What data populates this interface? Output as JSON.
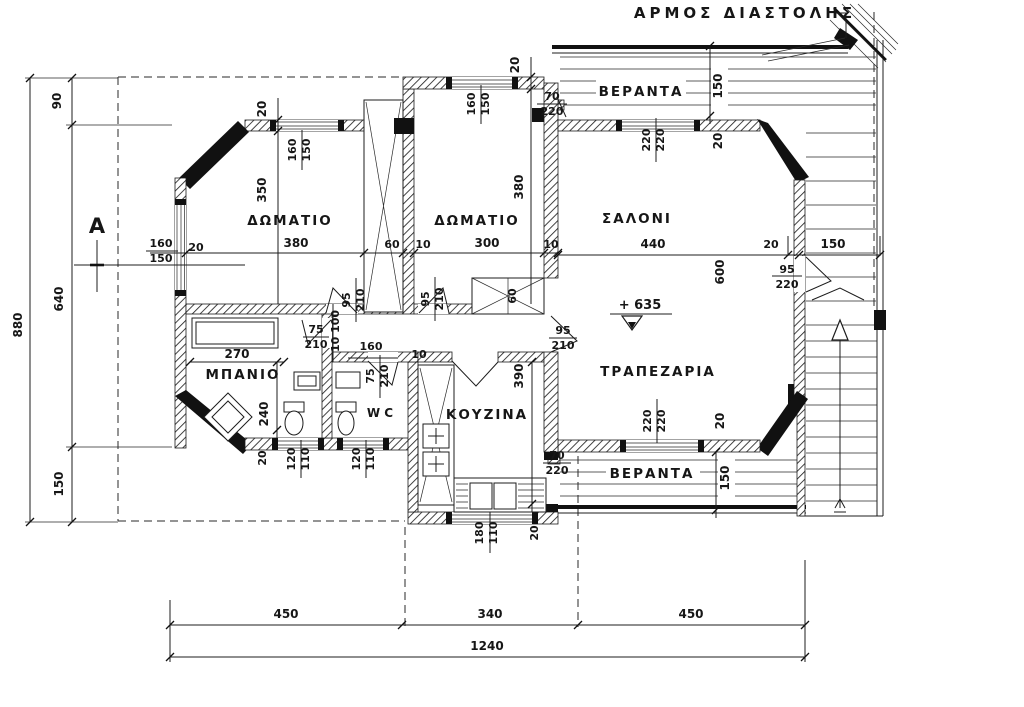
{
  "drawing": {
    "note": "ΑΡΜΟΣ ΔΙΑΣΤΟΛΗΣ",
    "level": "+ 635",
    "section": "A",
    "rooms": {
      "bedroom1": "ΔΩΜΑΤΙΟ",
      "bedroom2": "ΔΩΜΑΤΙΟ",
      "living": "ΣΑΛΟΝΙ",
      "dining": "ΤΡΑΠΕΖΑΡΙΑ",
      "kitchen": "ΚΟΥΖΙΝΑ",
      "bath": "ΜΠΑΝΙΟ",
      "wc": "W C",
      "veranda_top": "ΒΕΡΑΝΤΑ",
      "veranda_bottom": "ΒΕΡΑΝΤΑ"
    },
    "dims": {
      "total_h": "880",
      "seg90": "90",
      "seg640": "640",
      "seg150": "150",
      "bot450l": "450",
      "bot340": "340",
      "bot450r": "450",
      "bot1240": "1240",
      "w20_b1top": "20",
      "b1win_w": "160",
      "b1win_h": "150",
      "b1_350": "350",
      "b1_380": "380",
      "b1lwin_w": "160",
      "b1lwin_h": "150",
      "b1lwin_20": "20",
      "ward_60": "60",
      "ward_10": "10",
      "b2_300": "300",
      "b2_380": "380",
      "b2_10r": "10",
      "w20_b2top": "20",
      "b2win_w": "160",
      "b2win_h": "150",
      "door_top_w": "70",
      "door_top_h": "220",
      "vtop_150": "150",
      "salwin_w": "220",
      "salwin_h": "220",
      "w20_saltop": "20",
      "sal_440": "440",
      "sal_600": "600",
      "land_20": "20",
      "land_150": "150",
      "door_land_w": "95",
      "door_land_h": "220",
      "dinwin_w": "220",
      "dinwin_h": "220",
      "w20_dinbot": "20",
      "vbot_150": "150",
      "door_kit_w": "70",
      "door_kit_h": "220",
      "kitwin_w": "180",
      "kitwin_h": "110",
      "w20_kitbot": "20",
      "kit_390": "390",
      "kit_10": "10",
      "hall_160": "160",
      "hall_10100": "10 100",
      "door_b1_w": "95",
      "door_b1_h": "210",
      "door_b2_w": "95",
      "door_b2_h": "210",
      "door_din_w": "95",
      "door_din_h": "210",
      "door_wc_w": "75",
      "door_wc_h": "210",
      "door_bath_w": "75",
      "door_bath_h": "210",
      "bath_270": "270",
      "bath_240": "240",
      "bathwin_w": "120",
      "bathwin_h": "110",
      "bath_20": "20",
      "wcwin_w": "120",
      "wcwin_h": "110",
      "clo2_60": "60"
    }
  }
}
